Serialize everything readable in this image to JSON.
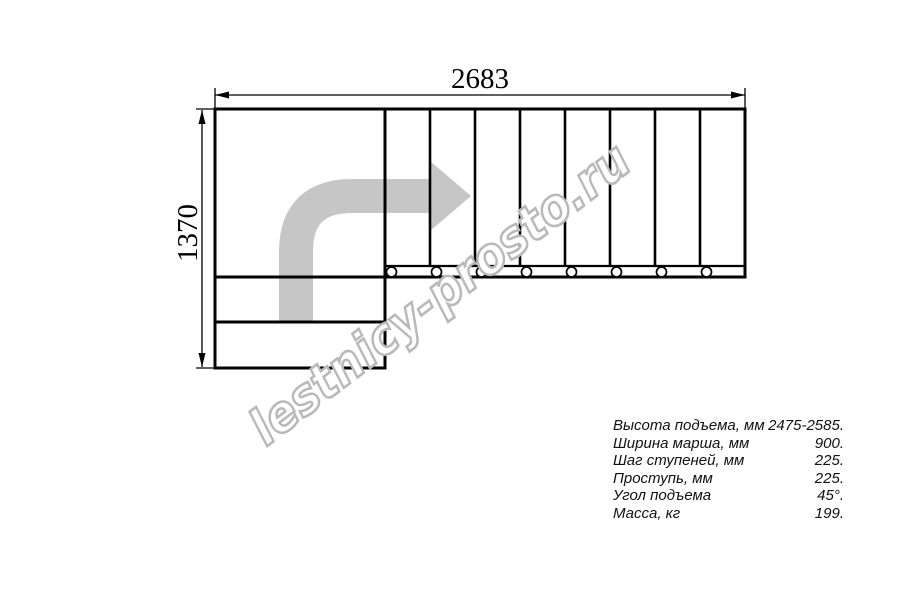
{
  "drawing": {
    "title": "staircase-plan-view",
    "dimensions": {
      "width_mm": "2683",
      "height_mm": "1370"
    },
    "treads_count": 8,
    "colors": {
      "line": "#000000",
      "arrow": "#c6c6c6",
      "watermark": "#b9b9b9",
      "background": "#ffffff"
    }
  },
  "watermark": {
    "text": "lestnicy-prosto.ru"
  },
  "specs": {
    "rows": [
      {
        "label": "Высота подъема, мм",
        "value": "2475-2585."
      },
      {
        "label": "Ширина марша, мм",
        "value": "900."
      },
      {
        "label": "Шаг ступеней, мм",
        "value": "225."
      },
      {
        "label": "Проступь, мм",
        "value": "225."
      },
      {
        "label": "Угол подъема",
        "value": "45°."
      },
      {
        "label": "Масса, кг",
        "value": "199."
      }
    ]
  }
}
